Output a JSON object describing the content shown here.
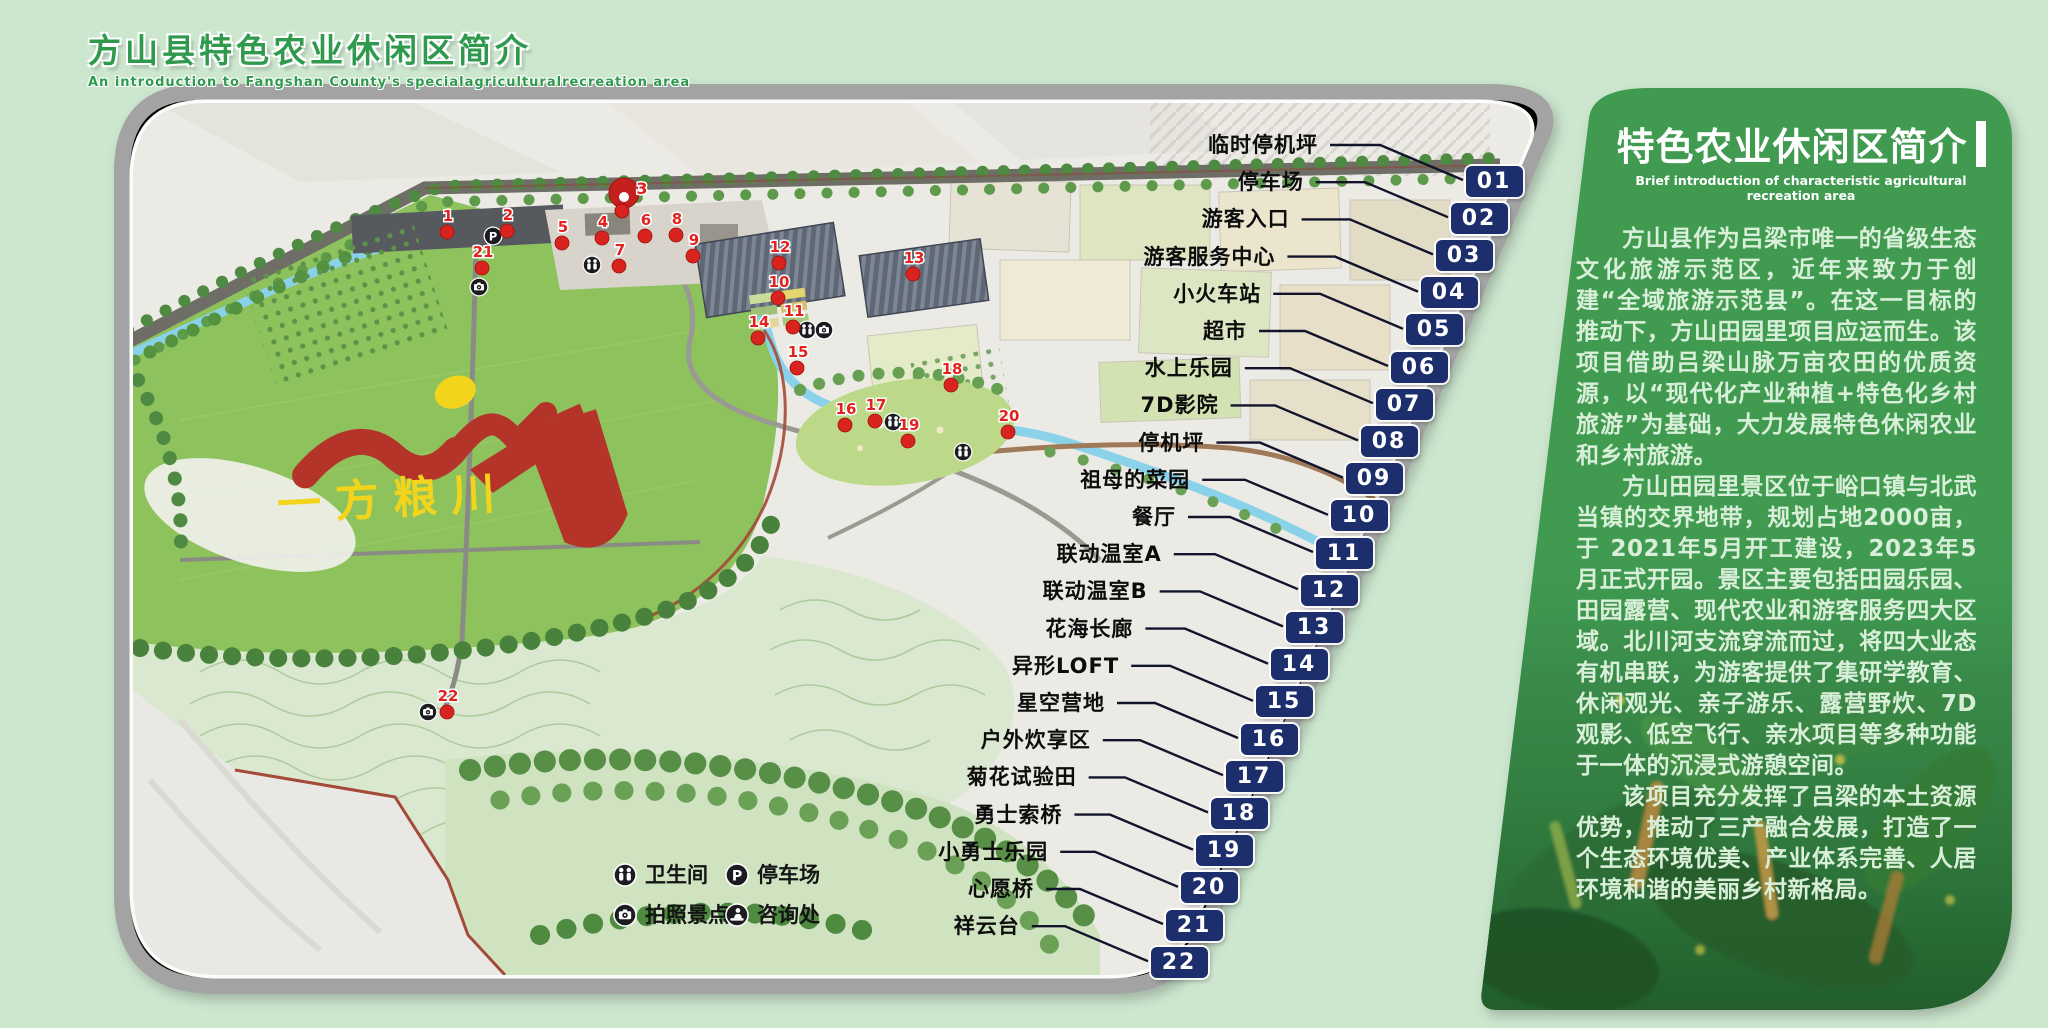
{
  "header": {
    "title": "方山县特色农业休闲区简介",
    "subtitle": "An introduction to Fangshan County's specialagriculturalrecreation area"
  },
  "map": {
    "land_art_text": "一方粮川",
    "legend": [
      {
        "icon": "restroom-icon",
        "label": "卫生间"
      },
      {
        "icon": "parking-icon",
        "label": "停车场"
      },
      {
        "icon": "camera-icon",
        "label": "拍照景点"
      },
      {
        "icon": "info-icon",
        "label": "咨询处"
      }
    ],
    "callouts": [
      {
        "num": "01",
        "label": "临时停机坪"
      },
      {
        "num": "02",
        "label": "停车场"
      },
      {
        "num": "03",
        "label": "游客入口"
      },
      {
        "num": "04",
        "label": "游客服务中心"
      },
      {
        "num": "05",
        "label": "小火车站"
      },
      {
        "num": "06",
        "label": "超市"
      },
      {
        "num": "07",
        "label": "水上乐园"
      },
      {
        "num": "08",
        "label": "7D影院"
      },
      {
        "num": "09",
        "label": "停机坪"
      },
      {
        "num": "10",
        "label": "祖母的菜园"
      },
      {
        "num": "11",
        "label": "餐厅"
      },
      {
        "num": "12",
        "label": "联动温室A"
      },
      {
        "num": "13",
        "label": "联动温室B"
      },
      {
        "num": "14",
        "label": "花海长廊"
      },
      {
        "num": "15",
        "label": "异形LOFT"
      },
      {
        "num": "16",
        "label": "星空营地"
      },
      {
        "num": "17",
        "label": "户外炊享区"
      },
      {
        "num": "18",
        "label": "菊花试验田"
      },
      {
        "num": "19",
        "label": "勇士索桥"
      },
      {
        "num": "20",
        "label": "小勇士乐园"
      },
      {
        "num": "21",
        "label": "心愿桥"
      },
      {
        "num": "22",
        "label": "祥云台"
      }
    ],
    "markers": [
      {
        "n": "1",
        "x": 447,
        "y": 232
      },
      {
        "n": "2",
        "x": 507,
        "y": 231
      },
      {
        "n": "3",
        "x": 624,
        "y": 196,
        "big": true
      },
      {
        "n": "4",
        "x": 602,
        "y": 238
      },
      {
        "n": "5",
        "x": 562,
        "y": 243
      },
      {
        "n": "6",
        "x": 645,
        "y": 236
      },
      {
        "n": "7",
        "x": 619,
        "y": 266
      },
      {
        "n": "8",
        "x": 676,
        "y": 235
      },
      {
        "n": "9",
        "x": 693,
        "y": 256
      },
      {
        "n": "10",
        "x": 778,
        "y": 298
      },
      {
        "n": "11",
        "x": 793,
        "y": 327
      },
      {
        "n": "12",
        "x": 779,
        "y": 263
      },
      {
        "n": "13",
        "x": 913,
        "y": 274
      },
      {
        "n": "14",
        "x": 758,
        "y": 338
      },
      {
        "n": "15",
        "x": 797,
        "y": 368
      },
      {
        "n": "16",
        "x": 845,
        "y": 425
      },
      {
        "n": "17",
        "x": 875,
        "y": 421
      },
      {
        "n": "18",
        "x": 951,
        "y": 385
      },
      {
        "n": "19",
        "x": 908,
        "y": 441
      },
      {
        "n": "20",
        "x": 1008,
        "y": 432
      },
      {
        "n": "21",
        "x": 482,
        "y": 268
      },
      {
        "n": "22",
        "x": 447,
        "y": 712
      }
    ],
    "map_icons": [
      {
        "type": "parking",
        "x": 493,
        "y": 236
      },
      {
        "type": "restroom",
        "x": 592,
        "y": 265
      },
      {
        "type": "camera",
        "x": 479,
        "y": 287
      },
      {
        "type": "restroom",
        "x": 807,
        "y": 330
      },
      {
        "type": "camera",
        "x": 824,
        "y": 330
      },
      {
        "type": "restroom",
        "x": 893,
        "y": 422
      },
      {
        "type": "restroom",
        "x": 963,
        "y": 452
      },
      {
        "type": "camera",
        "x": 428,
        "y": 712
      }
    ]
  },
  "panel": {
    "title": "特色农业休闲区简介",
    "subtitle": "Brief introduction of characteristic agricultural recreation area",
    "paragraphs": [
      "方山县作为吕梁市唯一的省级生态文化旅游示范区，近年来致力于创建“全域旅游示范县”。在这一目标的推动下，方山田园里项目应运而生。该项目借助吕梁山脉万亩农田的优质资源，以“现代化产业种植+特色化乡村旅游”为基础，大力发展特色休闲农业和乡村旅游。",
      "方山田园里景区位于峪口镇与北武当镇的交界地带，规划占地2000亩，于 2021年5月开工建设，2023年5月正式开园。景区主要包括田园乐园、田园露营、现代农业和游客服务四大区域。北川河支流穿流而过，将四大业态有机串联，为游客提供了集研学教育、休闲观光、亲子游乐、露营野炊、7D观影、低空飞行、亲水项目等多种功能于一体的沉浸式游憩空间。",
      "该项目充分发挥了吕梁的本土资源优势，推动了三产融合发展，打造了一个生态环境优美、产业体系完善、人居环境和谐的美丽乡村新格局。"
    ]
  },
  "colors": {
    "page_bg": "#cde7cf",
    "panel_green": "#3f9b51",
    "badge_navy": "#1d2e6d",
    "marker_red": "#d8231f",
    "field_green": "#8ec25c",
    "river_blue": "#8ad2ea",
    "art_red": "#b5342a",
    "art_yellow": "#f2d41c"
  }
}
